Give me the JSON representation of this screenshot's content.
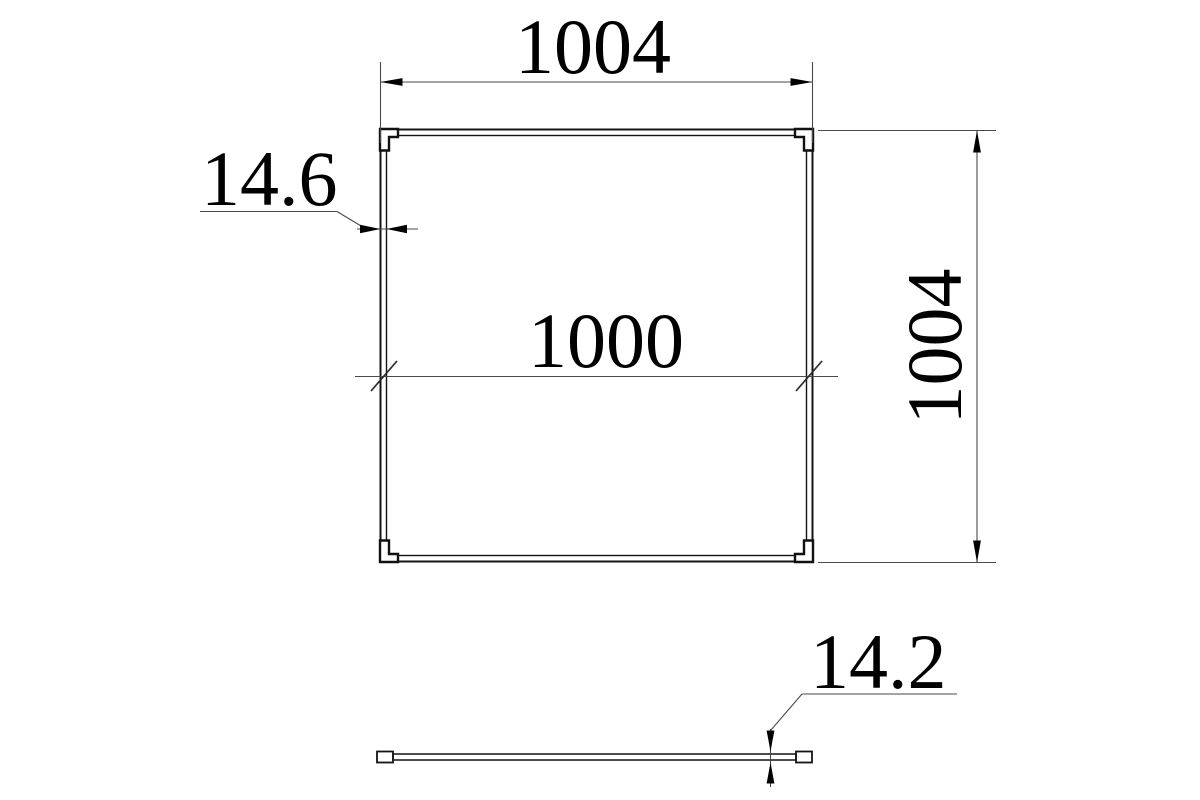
{
  "drawing": {
    "kind": "technical-dimension-drawing",
    "views": {
      "front": {
        "outer_width": "1004",
        "outer_height": "1004",
        "inner_width": "1000",
        "frame_thickness": "14.6"
      },
      "side": {
        "thickness": "14.2"
      }
    },
    "colors": {
      "background": "#ffffff",
      "outline": "#141414",
      "thin_line": "#4a4a4a",
      "text": "#000000"
    }
  }
}
